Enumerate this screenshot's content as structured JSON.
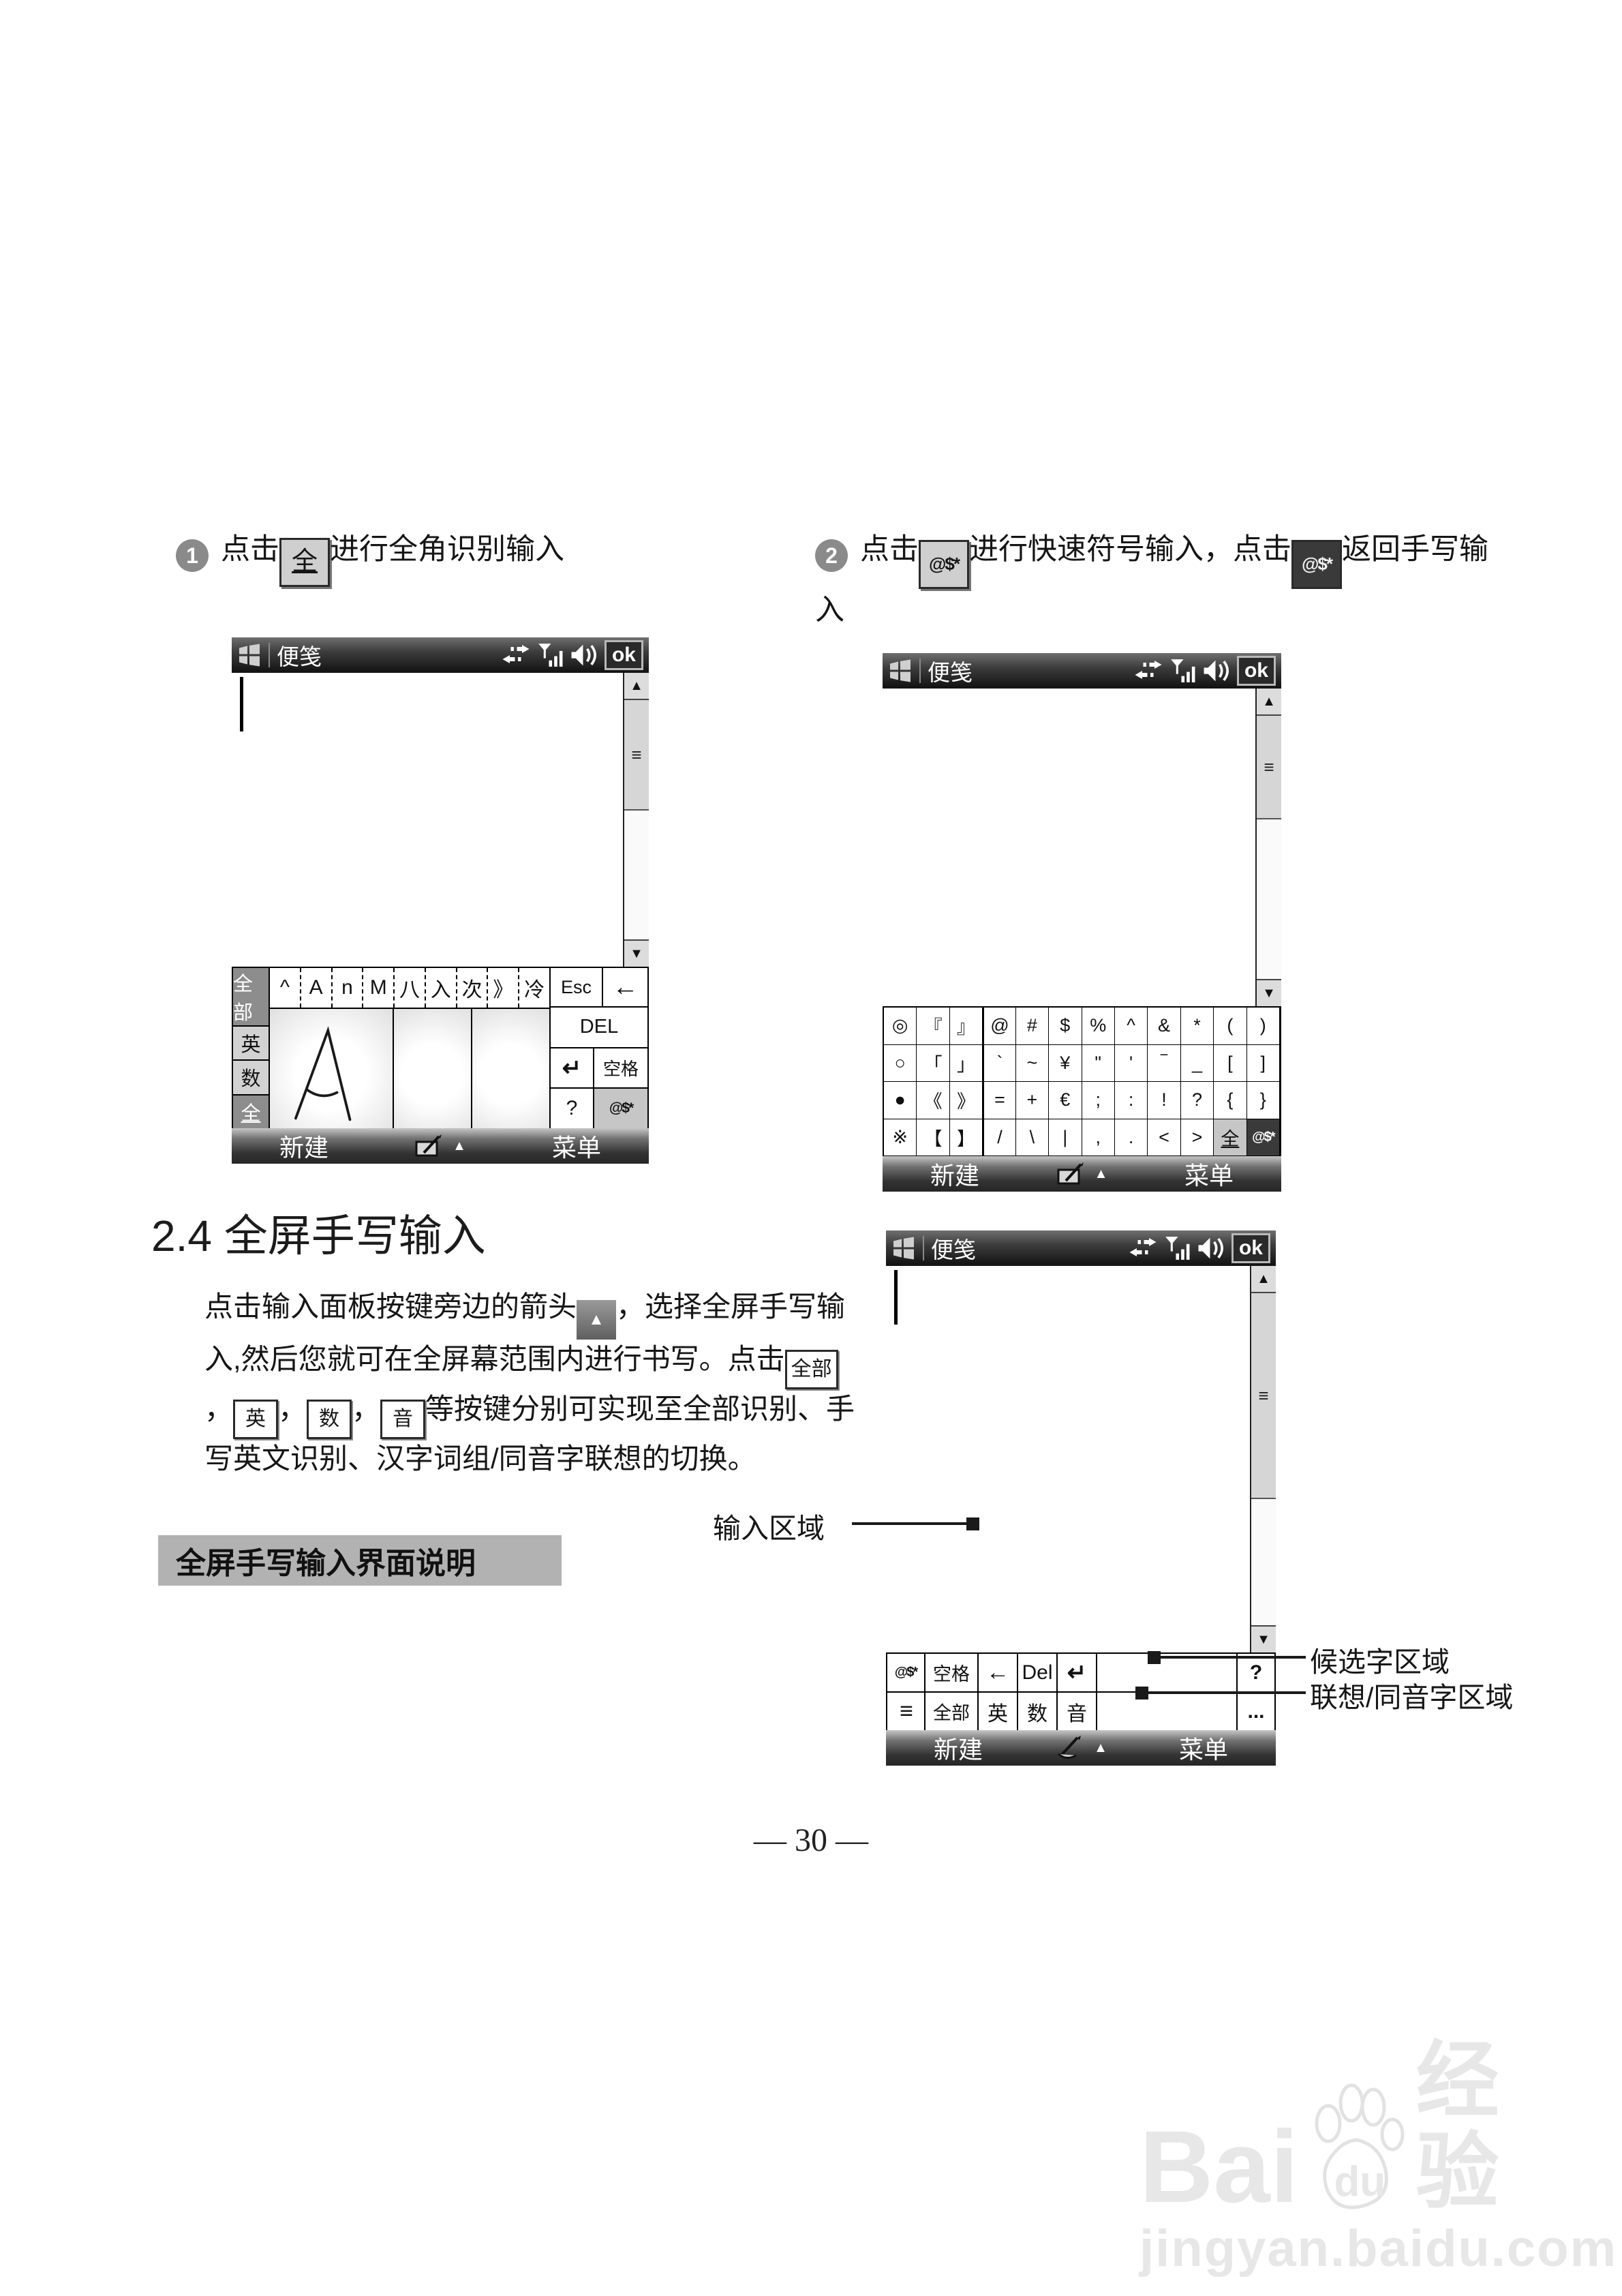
{
  "steps": {
    "one": {
      "num": "1",
      "before": "点击",
      "key": "全",
      "after": "进行全角识别输入"
    },
    "two": {
      "num": "2",
      "before": "点击",
      "key1": "@$*",
      "mid": "进行快速符号输入，点击",
      "key2": "@$*",
      "after": "返回手写输入"
    }
  },
  "section": {
    "heading": "2.4 全屏手写输入",
    "para1": "点击输入面板按键旁边的箭头",
    "arrow_key": "▲",
    "para2": "，选择全屏手写输入,然后您就可在全屏幕范围内进行书写。点击",
    "key_all": "全部",
    "key_eng": "英",
    "key_num": "数",
    "key_pinyin": "音",
    "comma": "，",
    "para3": "等按键分别可实现至全部识别、手写英文识别、汉字词组/同音字联想的切换。",
    "label_box": "全屏手写输入界面说明"
  },
  "annotations": {
    "input_area": "输入区域",
    "candidate_area": "候选字区域",
    "assoc_area": "联想/同音字区域"
  },
  "page_number": "— 30 —",
  "watermark": {
    "brand_left": "Bai",
    "brand_du": "du",
    "brand_cn": "经验",
    "url": "jingyan.baidu.com"
  },
  "pda_common": {
    "title": "便笺",
    "ok": "ok",
    "softkey_left": "新建",
    "softkey_right": "菜单",
    "scroll_grip": "≡",
    "up": "▲",
    "down": "▼"
  },
  "pda_a": {
    "mode_keys": [
      "全部",
      "英",
      "数",
      "全"
    ],
    "candidates": [
      "^",
      "A",
      "n",
      "M",
      "八",
      "入",
      "次",
      "》",
      "冷"
    ],
    "esc": "Esc",
    "backspace": "←",
    "del": "DEL",
    "enter": "↵",
    "space": "空格",
    "help": "?",
    "symbol_key": "@$*"
  },
  "pda_b": {
    "symbols": [
      "◎",
      "『",
      "』",
      "@",
      "#",
      "$",
      "%",
      "^",
      "&",
      "*",
      "(",
      ")",
      "○",
      "「",
      "」",
      "`",
      "~",
      "¥",
      "\"",
      "'",
      "‾",
      "_",
      "[",
      "]",
      "●",
      "《",
      "》",
      "=",
      "+",
      "€",
      ";",
      ":",
      "!",
      "?",
      "{",
      "}",
      "※",
      "【",
      "】",
      "/",
      "\\",
      "|",
      ",",
      ".",
      "<",
      ">",
      "全",
      "@$*"
    ]
  },
  "pda_c": {
    "row1": {
      "symbol": "@$*",
      "space": "空格",
      "backspace": "←",
      "del": "Del",
      "enter": "↵",
      "help": "?"
    },
    "row2": {
      "list": "≡",
      "all": "全部",
      "eng": "英",
      "num": "数",
      "pinyin": "音",
      "more": "..."
    }
  }
}
